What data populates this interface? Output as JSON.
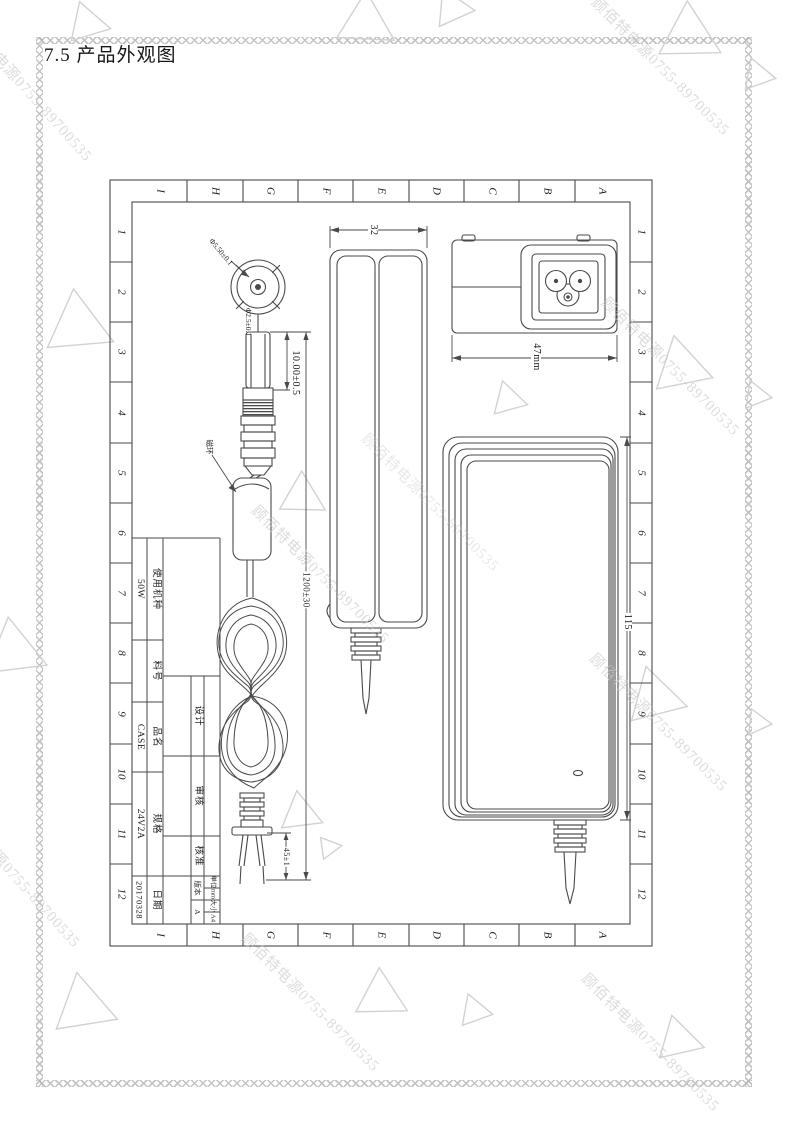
{
  "page": {
    "title": "7.5 产品外观图",
    "watermark_text": "顾佰特电源0755-89700535"
  },
  "sheet": {
    "col_letters": [
      "I",
      "H",
      "G",
      "F",
      "E",
      "D",
      "C",
      "B",
      "A"
    ],
    "row_numbers": [
      "1",
      "2",
      "3",
      "4",
      "5",
      "6",
      "7",
      "8",
      "9",
      "10",
      "11",
      "12"
    ]
  },
  "drawing": {
    "dims": {
      "inlet_width": "47mm",
      "side_thickness": "32",
      "front_length": "115",
      "cable_length": "1200±30",
      "plug_barrel_length": "10.00±0.5",
      "wire_strip_length": "45±1",
      "plug_outer_dia": "Φ5.50±0.1",
      "plug_inner_dia": "Φ2.5±0.1"
    },
    "callouts": {
      "ferrite_bead": "磁环"
    }
  },
  "title_block": {
    "rows": [
      {
        "label": "使用机种",
        "value": "50W"
      },
      {
        "label": "料号",
        "value": ""
      },
      {
        "label": "品名",
        "value": "CASE"
      },
      {
        "label": "规格",
        "value": "24V2A"
      },
      {
        "label": "日期",
        "value": "20170328"
      }
    ],
    "signoff": [
      {
        "label": "设计",
        "value": ""
      },
      {
        "label": "审核",
        "value": ""
      },
      {
        "label": "核准",
        "value": ""
      }
    ],
    "meta": [
      {
        "label": "单位",
        "value": "mm"
      },
      {
        "label": "大小",
        "value": "A4"
      },
      {
        "label": "版本",
        "value": "A"
      }
    ]
  }
}
